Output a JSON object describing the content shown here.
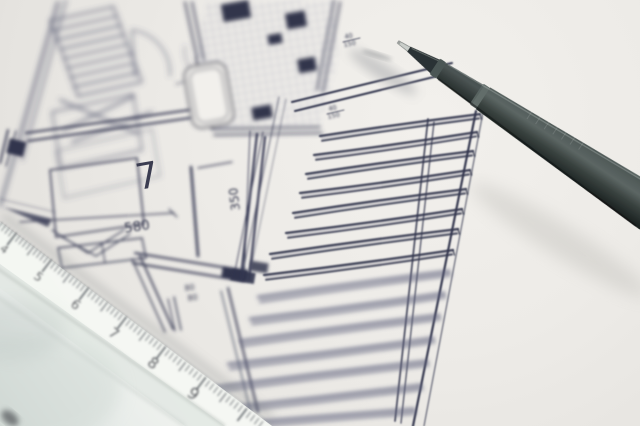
{
  "scene": {
    "description": "Close-up photograph of an architectural floor-plan blueprint with a dark fineliner pen resting on the paper and a white ruler crossing the lower-left corner"
  },
  "floorplan": {
    "room_number": "7",
    "width_dimension": "580",
    "wall_dimension": "350",
    "door_dimension": {
      "top": "80",
      "bottom": "80"
    },
    "post_dimension_upper": {
      "top": "40",
      "bottom": "150"
    },
    "post_dimension_lower": {
      "top": "40",
      "bottom": "150"
    }
  },
  "ruler": {
    "numbers": [
      "4",
      "5",
      "6",
      "7",
      "8",
      "9"
    ]
  },
  "colors": {
    "paper": "#eceae6",
    "ink": "#3c3f58",
    "ink_faded": "#5d6080",
    "pen_body": "#3e4847",
    "pen_tip": "#cfd2cf",
    "ruler_face": "#f3f5f1",
    "ruler_shade": "#c7cfca"
  }
}
